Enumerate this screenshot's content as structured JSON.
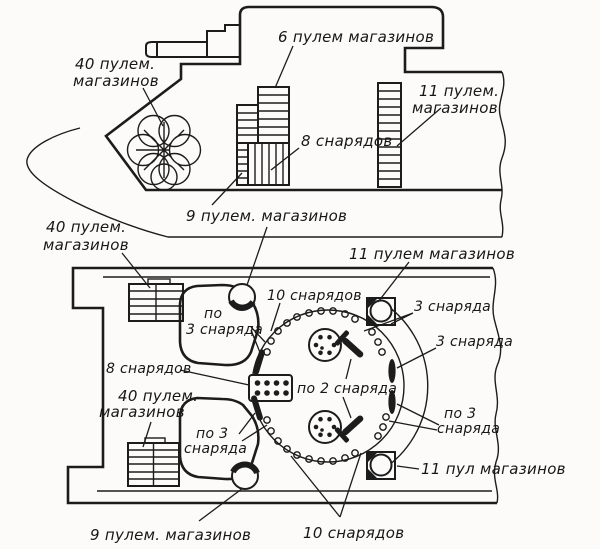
{
  "figure": {
    "description_type": "tank-ammunition-stowage-diagram",
    "colors": {
      "ink": "#1c1c1c",
      "paper": "#fcfbf9"
    },
    "side_view": {
      "label_40_mg_line1": "40 пулем.",
      "label_40_mg_line2": "магазинов",
      "label_6_mg": "6 пулем магазинов",
      "label_11_mg_line1": "11 пулем.",
      "label_11_mg_line2": "магазинов",
      "label_8_shells": "8 снарядов",
      "label_9_mg": "9 пулем. магазинов"
    },
    "plan_view": {
      "label_40_mg_top_line1": "40 пулем.",
      "label_40_mg_top_line2": "магазинов",
      "label_11_mg_top": "11 пулем магазинов",
      "label_10_shells_top": "10 снарядов",
      "label_3_shells_1": "3 снаряда",
      "label_3_shells_2": "3 снаряда",
      "label_per3_top_line1": "по",
      "label_per3_top_line2": "3 снаряда",
      "label_8_shells": "8 снарядов",
      "label_per2_shells": "по 2 снаряда",
      "label_40_mg_bottom_line1": "40 пулем.",
      "label_40_mg_bottom_line2": "магазинов",
      "label_per3_bottom_line1": "по 3",
      "label_per3_bottom_line2": "снаряда",
      "label_per3_right_line1": "по 3",
      "label_per3_right_line2": "снаряда",
      "label_11_mg_bottom": "11 пул магазинов",
      "label_9_mg_bottom": "9 пулем. магазинов",
      "label_10_shells_bottom": "10 снарядов"
    }
  }
}
